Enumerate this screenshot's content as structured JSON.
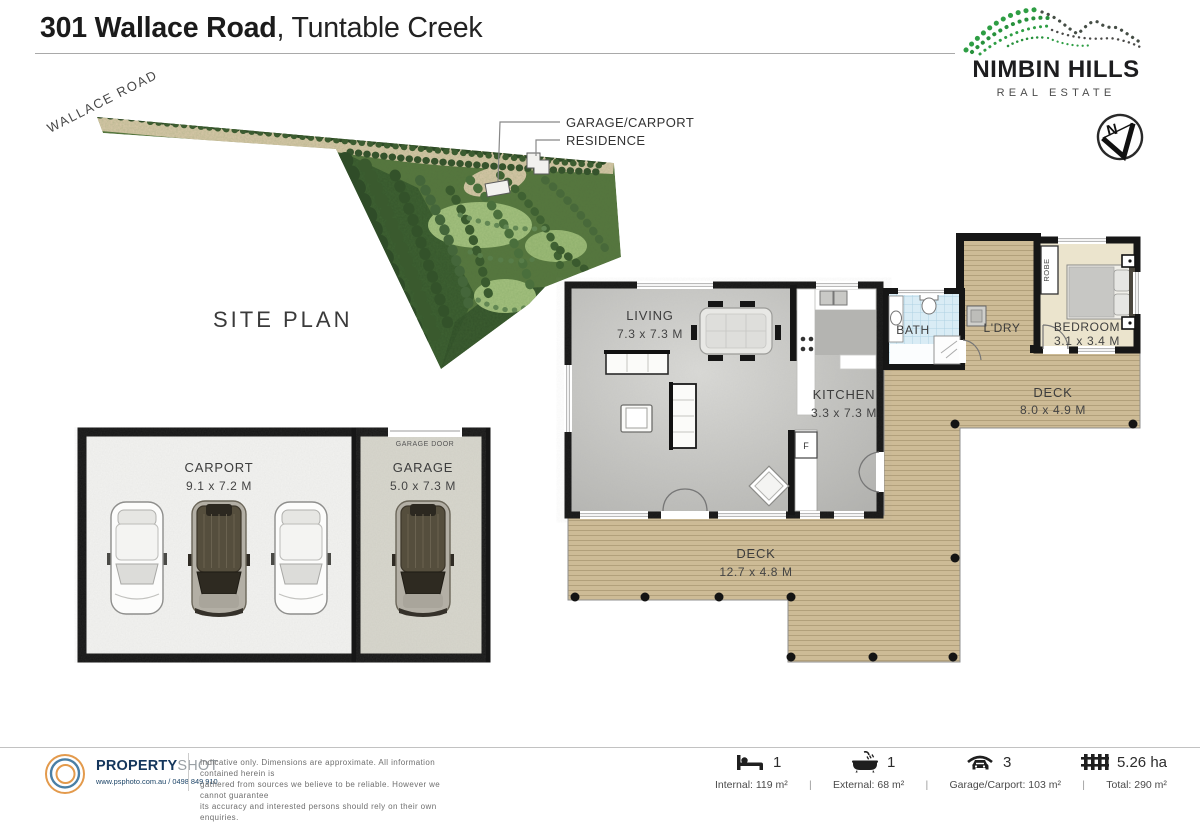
{
  "header": {
    "address_bold": "301 Wallace Road",
    "address_suffix": ", Tuntable Creek"
  },
  "brand": {
    "name": "NIMBIN HILLS",
    "tagline": "REAL ESTATE"
  },
  "compass": {
    "north": "N"
  },
  "site": {
    "title": "SITE PLAN",
    "road": "WALLACE ROAD",
    "callout_garage": "GARAGE/CARPORT",
    "callout_residence": "RESIDENCE"
  },
  "plan": {
    "living_name": "LIVING",
    "living_dims": "7.3 x 7.3 M",
    "kitchen_name": "KITCHEN",
    "kitchen_dims": "3.3 x 7.3 M",
    "bath_name": "BATH",
    "laundry_name": "L'DRY",
    "bedroom_name": "BEDROOM",
    "bedroom_dims": "3.1 x 3.4 M",
    "robe_name": "ROBE",
    "deck_right_name": "DECK",
    "deck_right_dims": "8.0 x 4.9 M",
    "deck_main_name": "DECK",
    "deck_main_dims": "12.7 x 4.8 M",
    "carport_name": "CARPORT",
    "carport_dims": "9.1 x 7.2 M",
    "garage_name": "GARAGE",
    "garage_dims": "5.0 x 7.3 M",
    "garage_door": "GARAGE DOOR",
    "fridge": "F"
  },
  "footer": {
    "brand_bold": "PROPERTY",
    "brand_light": "SHOT",
    "contact": "www.psphoto.com.au / 0498 849 910",
    "disclaimer_1": "Indicative only.  Dimensions are approximate.  All information contained herein is",
    "disclaimer_2": "gathered from sources we believe to be reliable.  However we cannot guarantee",
    "disclaimer_3": "its accuracy and interested persons should rely on their own enquiries.",
    "bed_count": "1",
    "bath_count": "1",
    "car_count": "3",
    "land_area": "5.26 ha",
    "area_internal": "Internal: 119 m²",
    "area_external": "External: 68 m²",
    "area_garage": "Garage/Carport: 103 m²",
    "area_total": "Total: 290 m²",
    "sep": "|"
  },
  "colors": {
    "accent_green": "#2e9e44",
    "wall": "#161616",
    "wood": "#cdbb96",
    "tile": "#d9ecf5"
  }
}
